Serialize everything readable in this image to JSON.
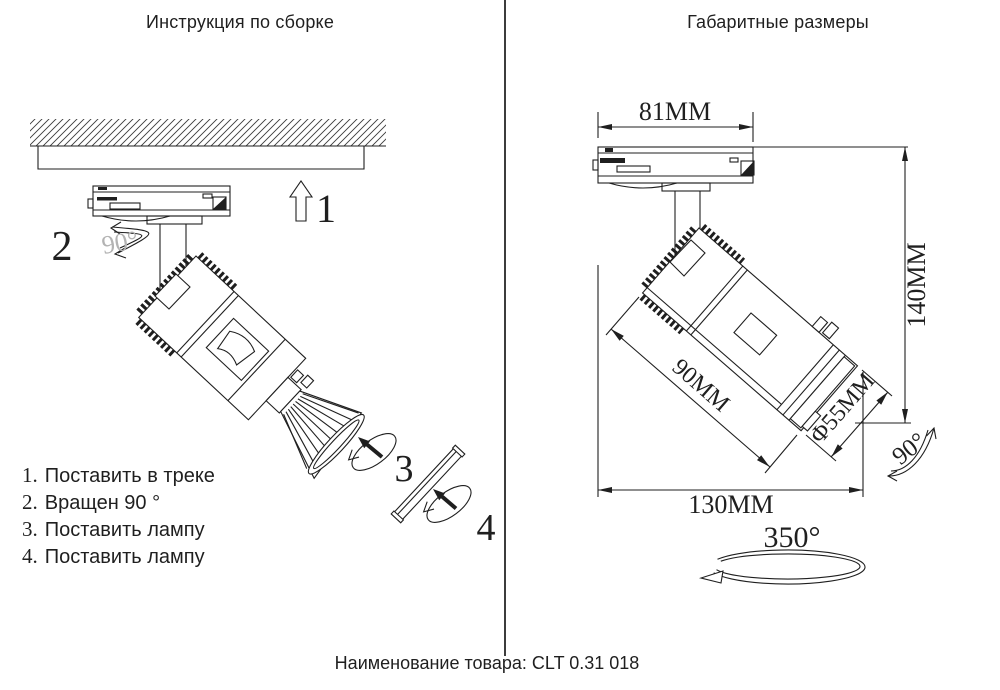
{
  "left_panel": {
    "title": "Инструкция по сборке",
    "markers": {
      "m1": "1",
      "m2": "2",
      "m2_angle": "90°",
      "m3": "3",
      "m4": "4"
    },
    "steps": [
      {
        "num": "1.",
        "text": "Поставить в треке"
      },
      {
        "num": "2.",
        "text": "Вращен 90 °"
      },
      {
        "num": "3.",
        "text": "Поставить лампу"
      },
      {
        "num": "4.",
        "text": "Поставить лампу"
      }
    ]
  },
  "right_panel": {
    "title": "Габаритные размеры",
    "dimensions": {
      "track_width": "81MM",
      "height": "140MM",
      "body_length": "90MM",
      "diameter": "Φ55MM",
      "total_width": "130MM",
      "tilt_angle": "90°",
      "rotation_angle": "350°"
    }
  },
  "footer": {
    "product_label": "Наименование товара: CLT 0.31 018"
  },
  "colors": {
    "line": "#1f1f1f",
    "muted": "#b3b3b3"
  }
}
